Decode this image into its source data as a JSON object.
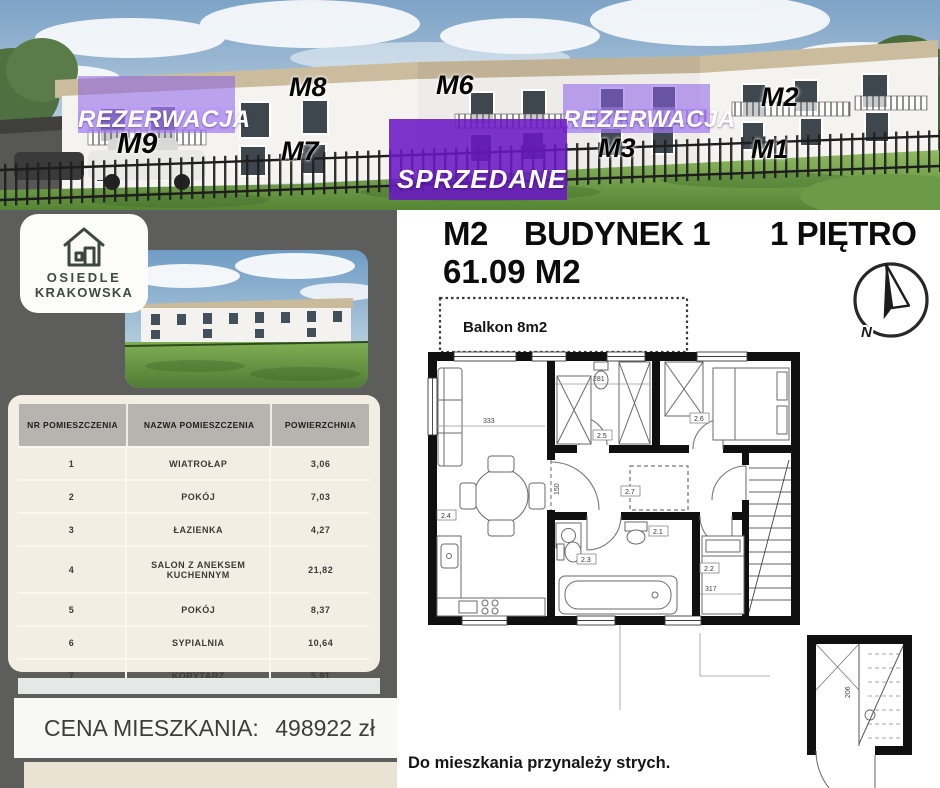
{
  "banner": {
    "reservation_label": "REZERWACJA",
    "sold_label": "SPRZEDANE",
    "units": {
      "m9": "M9",
      "m8": "M8",
      "m7": "M7",
      "m6": "M6",
      "m3": "M3",
      "m2": "M2",
      "m1": "M1"
    }
  },
  "left_panel": {
    "logo": {
      "line1": "OSIEDLE",
      "line2": "KRAKOWSKA"
    },
    "table": {
      "headers": {
        "nr": "NR POMIESZCZENIA",
        "name": "NAZWA POMIESZCZENIA",
        "area": "POWIERZCHNIA"
      },
      "rows": [
        {
          "nr": "1",
          "name": "WIATROŁAP",
          "area": "3,06"
        },
        {
          "nr": "2",
          "name": "POKÓJ",
          "area": "7,03"
        },
        {
          "nr": "3",
          "name": "ŁAZIENKA",
          "area": "4,27"
        },
        {
          "nr": "4",
          "name": "SALON Z ANEKSEM KUCHENNYM",
          "area": "21,82"
        },
        {
          "nr": "5",
          "name": "POKÓJ",
          "area": "8,37"
        },
        {
          "nr": "6",
          "name": "SYPIALNIA",
          "area": "10,64"
        },
        {
          "nr": "7",
          "name": "KORYTARZ",
          "area": "5,91"
        }
      ]
    },
    "price": {
      "label": "CENA MIESZKANIA:",
      "value": "498922 zł"
    }
  },
  "right_panel": {
    "unit": "M2",
    "building": "BUDYNEK 1",
    "floor": "1 PIĘTRO",
    "area": "61.09 M2",
    "compass_n": "N",
    "balcony_label": "Balkon 8m2",
    "footnote": "Do mieszkania przynależy strych.",
    "plan_labels": {
      "dim_333": "333",
      "dim_281": "281",
      "dim_150": "150",
      "dim_317": "317",
      "dim_206": "206",
      "room_21": "2.1",
      "room_22": "2.2",
      "room_23": "2.3",
      "room_24": "2.4",
      "room_25": "2.5",
      "room_26": "2.6",
      "room_27": "2.7"
    }
  },
  "colors": {
    "accent_purple": "#6a18c4",
    "light_purple": "#8d5ee9",
    "panel_gray": "#5d5d5b",
    "table_cream": "#f2eee3",
    "header_gray": "#b6b4af",
    "beige": "#eae3d3"
  }
}
